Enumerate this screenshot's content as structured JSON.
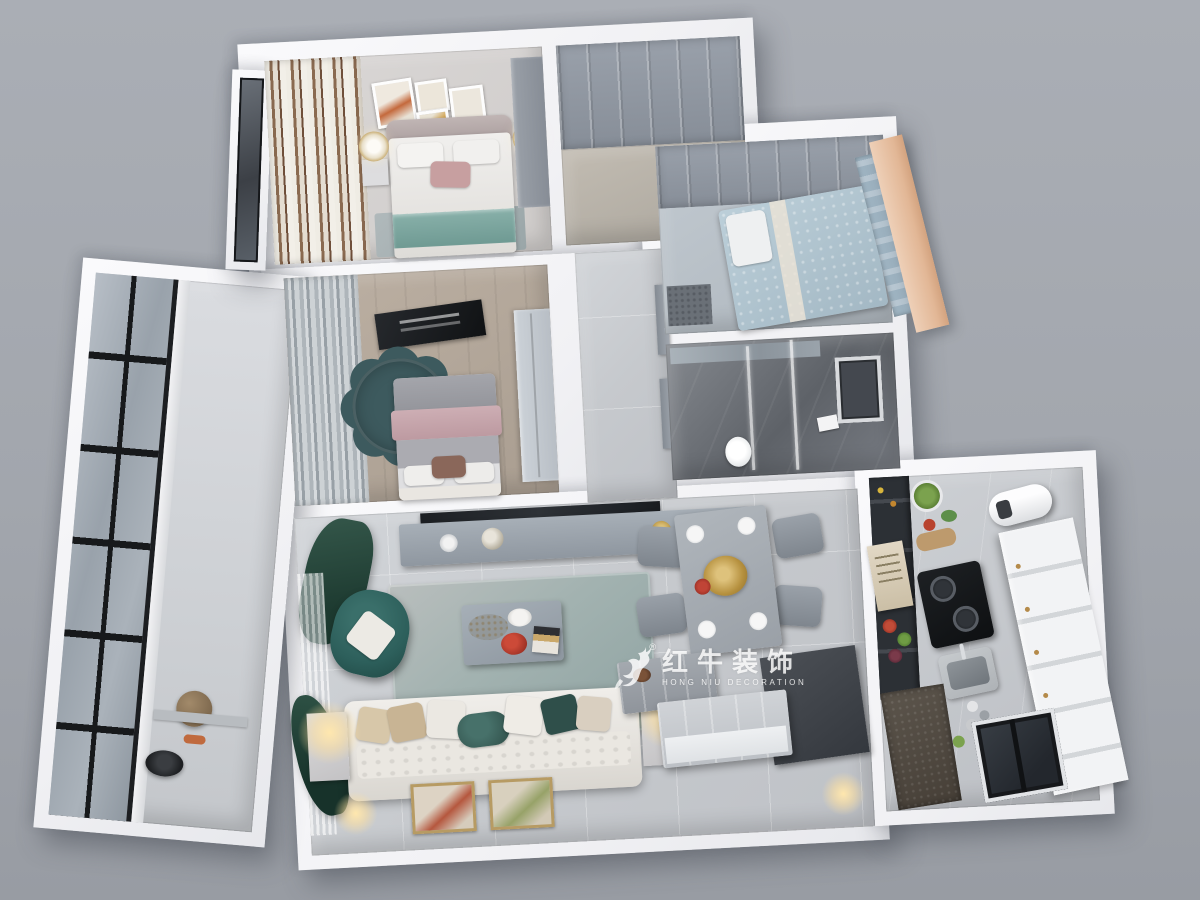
{
  "scene": {
    "type": "3d-dollhouse-floorplan-render",
    "background_top": "#aaaeb5",
    "background_bottom": "#989ca3",
    "wall_color": "#f5f5f7"
  },
  "watermark": {
    "logo_icon": "bull-logo",
    "registered_mark": "®",
    "brand_cn": "红牛装饰",
    "brand_en": "HONG NIU DECORATION",
    "color": "#ffffff"
  },
  "rooms": [
    {
      "id": "master-bedroom",
      "label": "master bedroom",
      "floor_color": "#d4d1d0",
      "furniture": [
        "double-bed",
        "teal-throw",
        "nightstand-lamps",
        "wall-art-frames",
        "striped-curtains",
        "wardrobe",
        "rug"
      ]
    },
    {
      "id": "foyer-cloakroom",
      "label": "foyer with wardrobe",
      "floor_color": "#bdb7ae",
      "furniture": [
        "panelled-wardrobe-top"
      ]
    },
    {
      "id": "hallway",
      "label": "hallway",
      "floor_color": "#c6c9cd",
      "furniture": [
        "interior-doors"
      ]
    },
    {
      "id": "second-bedroom",
      "label": "second bedroom",
      "floor_color": "#b2a699",
      "furniture": [
        "bed-pink-blanket",
        "flower-rug",
        "tv-panel",
        "gray-curtains",
        "wardrobe"
      ]
    },
    {
      "id": "third-bedroom",
      "label": "third bedroom",
      "floor_color": "#b9c2ca",
      "furniture": [
        "bed-blue-bedding",
        "panelled-wardrobe-top",
        "peach-bay-window"
      ]
    },
    {
      "id": "bathroom",
      "label": "bathroom",
      "floor_color": "#65696f",
      "furniture": [
        "glass-shower",
        "toilet",
        "window"
      ]
    },
    {
      "id": "balcony",
      "label": "balcony",
      "floor_color": "#d3d5d9",
      "furniture": [
        "black-frame-windows",
        "basket",
        "robot-vacuum"
      ]
    },
    {
      "id": "living-room",
      "label": "living room",
      "floor_color": "#c9ccd0",
      "furniture": [
        "tv-console",
        "tv",
        "green-drape",
        "teal-armchair",
        "area-rug",
        "coffee-table",
        "white-sofa",
        "pillows",
        "side-table-lamps",
        "wall-art"
      ]
    },
    {
      "id": "dining-area",
      "label": "dining area",
      "floor_color": "#c9ccd0",
      "furniture": [
        "dining-table",
        "four-chairs",
        "place-settings",
        "gold-centerpiece"
      ]
    },
    {
      "id": "kitchen",
      "label": "kitchen",
      "floor_color": "#c3c6ca",
      "furniture": [
        "dark-appliance-column",
        "white-cabinet-run",
        "gas-cooktop",
        "sink",
        "water-heater",
        "menu-board",
        "vegetables",
        "balcony-door",
        "doormat"
      ]
    },
    {
      "id": "entry",
      "label": "entry",
      "floor_color": "#c3c6ca",
      "furniture": [
        "shoe-cabinets",
        "storage-boxes"
      ]
    }
  ],
  "palette": {
    "teal_armchair": "#2d5f5b",
    "green_drape": "#2b4e44",
    "teal_throw": "#7ea7a1",
    "pink_blanket": "#c6a7ad",
    "flower_rug": "#3d5a5e",
    "living_rug": "#9fb0ad",
    "wood_floor": "#b2a699",
    "peach_bay_window": "#e7c6ac",
    "tv_black": "#202327",
    "dark_cabinet": "#3f434a",
    "white_cabinet": "#edeff1",
    "lamp_glow": "#ffe2a8",
    "gold_decor": "#c9a34a"
  }
}
